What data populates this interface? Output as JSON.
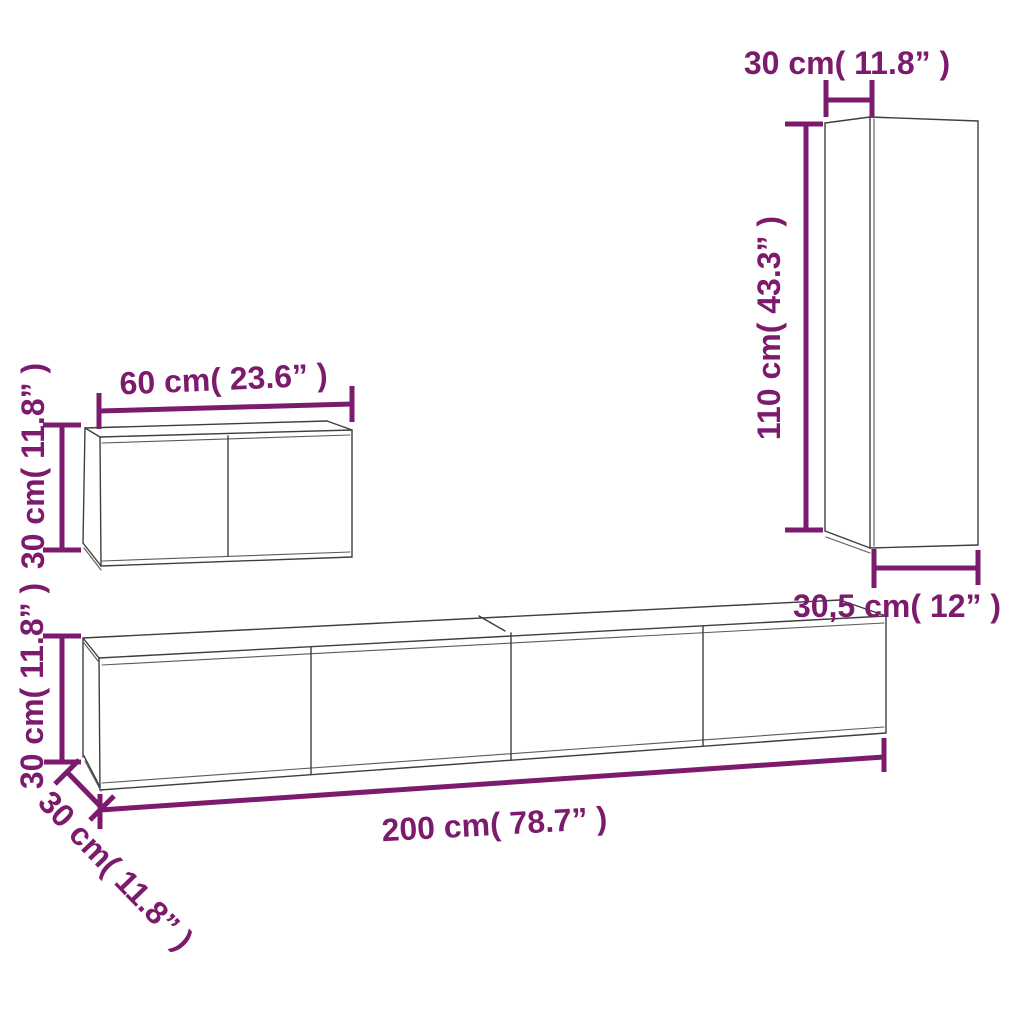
{
  "diagram": {
    "kind": "furniture-dimension-diagram",
    "colors": {
      "dimension_accent": "#7c1b6d",
      "cabinet_outline": "#3e3e3e",
      "background": "#ffffff"
    },
    "tall_cabinet": {
      "width_label": "30 cm( 11.8” )",
      "height_label": "110 cm( 43.3” )",
      "depth_label": "30,5 cm( 12” )"
    },
    "small_cabinet": {
      "width_label": "60 cm( 23.6” )",
      "height_label": "30 cm( 11.8” )"
    },
    "tv_stand": {
      "height_label": "30 cm( 11.8” )",
      "depth_label": "30 cm( 11.8” )",
      "width_label": "200 cm( 78.7” )"
    }
  }
}
